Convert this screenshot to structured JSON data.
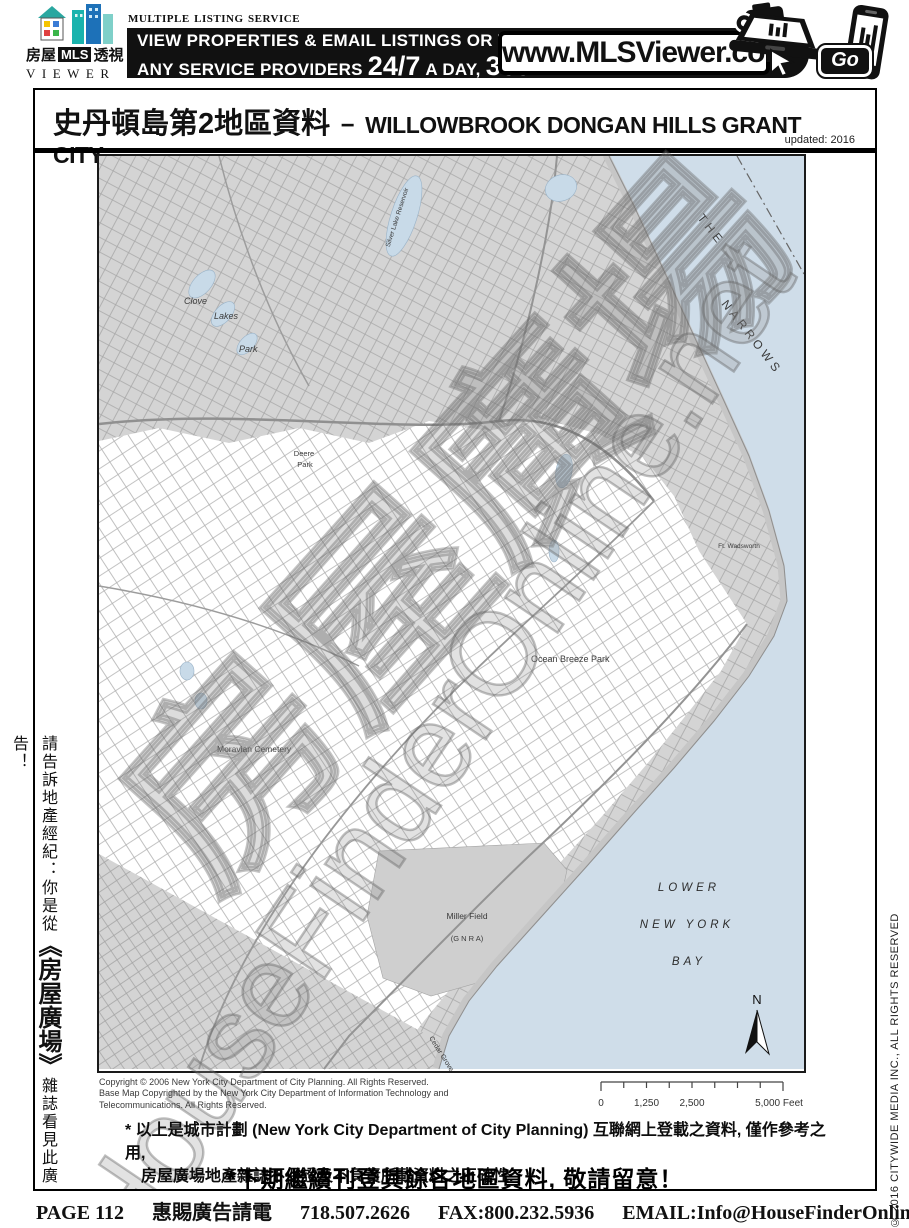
{
  "header": {
    "logo": {
      "left": "房屋",
      "mls": "MLS",
      "right": "透視",
      "viewer": "VIEWER"
    },
    "service": "Multiple Listing Service",
    "banner_line1": "VIEW PROPERTIES & EMAIL LISTINGS OR TO SEARCH",
    "banner_line2_pre": "ANY SERVICE PROVIDERS",
    "banner_247": "24/7",
    "banner_a_day": "A DAY,",
    "banner_365": "365",
    "banner_days": "DAYS",
    "url": "www.MLSViewer.com",
    "go": "Go"
  },
  "page": {
    "title_zh": "史丹頓島第2地區資料",
    "title_sep": "−",
    "title_en": "WILLOWBROOK DONGAN HILLS GRANT CITY...",
    "updated": "updated: 2016"
  },
  "map": {
    "watermark_en": "HouseFinderOnline.net",
    "watermark_zh": "房屋廣場",
    "labels": {
      "clove": "Clove",
      "lakes": "Lakes",
      "park": "Park",
      "silver": "Silver Lake Reservoir",
      "deere": "Deere",
      "deere2": "Park",
      "the": "THE",
      "narrows": "NARROWS",
      "ocean_breeze": "Ocean  Breeze  Park",
      "moravian": "Moravian  Cemetery",
      "miller": "Miller Field",
      "gnra": "(G N R A)",
      "ft_wadsworth": "Ft. Wadsworth",
      "bay1": "LOWER",
      "bay2": "NEW  YORK",
      "bay3": "BAY",
      "cedar": "Cedar Grove Beach",
      "north": "N"
    },
    "copyright": [
      "Copyright © 2006 New York City Department of City Planning.  All Rights Reserved.",
      "Base Map Copyrighted by the New York City Department of Information Technology and",
      "Telecommunications.  All Rights Reserved."
    ],
    "scale": {
      "t0": "0",
      "t1": "1,250",
      "t2": "2,500",
      "t3": "5,000 Feet"
    }
  },
  "sidebar_left": {
    "pre": "請告訴地產經紀：你是從",
    "brand": "《房屋廣場》",
    "post": "雜誌看見此廣告！"
  },
  "sidebar_right": {
    "text": "© 2016 CITYWIDE MEDIA INC., ALL RIGHTS RESERVED"
  },
  "disclaimer": {
    "line1": "* 以上是城市計劃 (New York City Department of City Planning) 互聯網上登載之資料, 僅作參考之用,",
    "line2": "房屋廣場地產雜誌不保證及不負責所載資料之正確性.",
    "notice": "*下期繼續刊登其餘各地區資料, 敬請留意！"
  },
  "footer": {
    "page": "PAGE 112",
    "ad": "惠賜廣告請電",
    "phone": "718.507.2626",
    "fax": "FAX:800.232.5936",
    "email": "EMAIL:Info@HouseFinderOnline.net",
    "date": "FEB. 2016"
  }
}
